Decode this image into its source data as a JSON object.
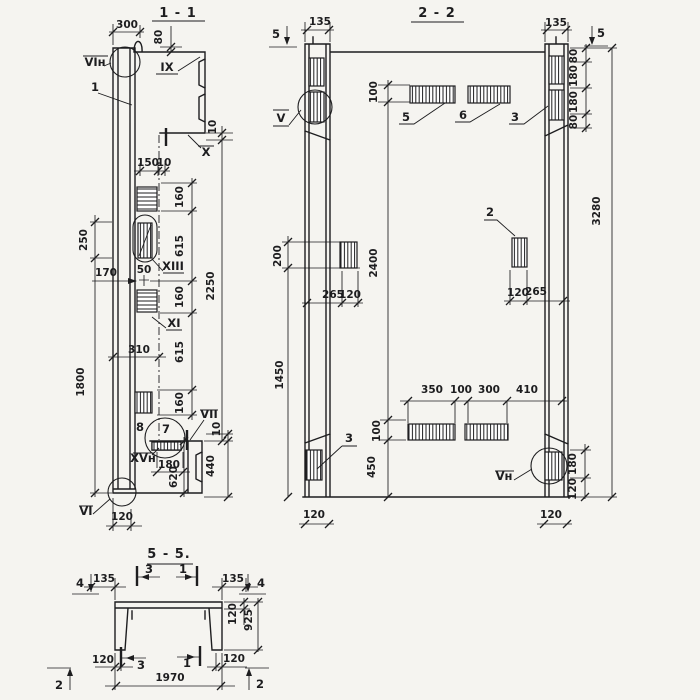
{
  "meta": {
    "ink": "#1d1d1f",
    "paper": "#f5f4f0"
  },
  "sections": {
    "s11": {
      "title": "1 - 1",
      "texts": [
        {
          "t": "300",
          "x": 127,
          "y": 28
        },
        {
          "t": "80",
          "x": 162,
          "y": 37,
          "r": 1
        },
        {
          "t": "VIн",
          "x": 95,
          "y": 66,
          "lbl": 1
        },
        {
          "t": "1",
          "x": 95,
          "y": 91,
          "lbl": 1
        },
        {
          "t": "IX",
          "x": 167,
          "y": 71,
          "lbl": 1
        },
        {
          "t": "10",
          "x": 216,
          "y": 127,
          "r": 1
        },
        {
          "t": "X",
          "x": 206,
          "y": 156,
          "lbl": 1
        },
        {
          "t": "150",
          "x": 148,
          "y": 166
        },
        {
          "t": "10",
          "x": 164,
          "y": 166
        },
        {
          "t": "160",
          "x": 183,
          "y": 197,
          "r": 1
        },
        {
          "t": "615",
          "x": 183,
          "y": 246,
          "r": 1
        },
        {
          "t": "160",
          "x": 183,
          "y": 297,
          "r": 1
        },
        {
          "t": "615",
          "x": 183,
          "y": 352,
          "r": 1
        },
        {
          "t": "160",
          "x": 183,
          "y": 403,
          "r": 1
        },
        {
          "t": "2250",
          "x": 214,
          "y": 286,
          "r": 1
        },
        {
          "t": "250",
          "x": 87,
          "y": 240,
          "r": 1
        },
        {
          "t": "1800",
          "x": 84,
          "y": 382,
          "r": 1
        },
        {
          "t": "170",
          "x": 106,
          "y": 276
        },
        {
          "t": "50",
          "x": 144,
          "y": 273
        },
        {
          "t": "XIII",
          "x": 173,
          "y": 270,
          "lbl": 1
        },
        {
          "t": "XI",
          "x": 174,
          "y": 327,
          "lbl": 1
        },
        {
          "t": "310",
          "x": 139,
          "y": 353
        },
        {
          "t": "8",
          "x": 140,
          "y": 431,
          "lbl": 1
        },
        {
          "t": "7",
          "x": 166,
          "y": 433,
          "lbl": 1
        },
        {
          "t": "VII",
          "x": 209,
          "y": 418,
          "lbl": 1
        },
        {
          "t": "10",
          "x": 220,
          "y": 429,
          "r": 1
        },
        {
          "t": "440",
          "x": 214,
          "y": 466,
          "r": 1
        },
        {
          "t": "XVн",
          "x": 143,
          "y": 462,
          "lbl": 1
        },
        {
          "t": "180",
          "x": 169,
          "y": 468
        },
        {
          "t": "620",
          "x": 177,
          "y": 477,
          "r": 1
        },
        {
          "t": "VI",
          "x": 86,
          "y": 515,
          "lbl": 1
        },
        {
          "t": "120",
          "x": 122,
          "y": 520
        }
      ]
    },
    "s22": {
      "title": "2 - 2",
      "texts": [
        {
          "t": "135",
          "x": 320,
          "y": 25
        },
        {
          "t": "135",
          "x": 556,
          "y": 26
        },
        {
          "t": "5",
          "x": 276,
          "y": 38,
          "lbl": 1
        },
        {
          "t": "5",
          "x": 601,
          "y": 37,
          "lbl": 1
        },
        {
          "t": "100",
          "x": 377,
          "y": 92,
          "r": 1
        },
        {
          "t": "5",
          "x": 406,
          "y": 121,
          "lbl": 1
        },
        {
          "t": "6",
          "x": 463,
          "y": 119,
          "lbl": 1
        },
        {
          "t": "3",
          "x": 515,
          "y": 121,
          "lbl": 1
        },
        {
          "t": "V",
          "x": 281,
          "y": 122,
          "lbl": 1
        },
        {
          "t": "80",
          "x": 577,
          "y": 56,
          "r": 1
        },
        {
          "t": "180",
          "x": 577,
          "y": 76,
          "r": 1
        },
        {
          "t": "180",
          "x": 577,
          "y": 102,
          "r": 1
        },
        {
          "t": "80",
          "x": 577,
          "y": 122,
          "r": 1
        },
        {
          "t": "3280",
          "x": 600,
          "y": 211,
          "r": 1
        },
        {
          "t": "200",
          "x": 281,
          "y": 256,
          "r": 1
        },
        {
          "t": "2400",
          "x": 377,
          "y": 263,
          "r": 1
        },
        {
          "t": "1450",
          "x": 283,
          "y": 375,
          "r": 1
        },
        {
          "t": "2",
          "x": 490,
          "y": 216,
          "lbl": 1
        },
        {
          "t": "265",
          "x": 333,
          "y": 298
        },
        {
          "t": "120",
          "x": 350,
          "y": 298
        },
        {
          "t": "120",
          "x": 518,
          "y": 296
        },
        {
          "t": "265",
          "x": 536,
          "y": 295
        },
        {
          "t": "350",
          "x": 432,
          "y": 393
        },
        {
          "t": "100",
          "x": 461,
          "y": 393
        },
        {
          "t": "300",
          "x": 489,
          "y": 393
        },
        {
          "t": "410",
          "x": 527,
          "y": 393
        },
        {
          "t": "100",
          "x": 380,
          "y": 431,
          "r": 1
        },
        {
          "t": "450",
          "x": 375,
          "y": 467,
          "r": 1
        },
        {
          "t": "3",
          "x": 349,
          "y": 442,
          "lbl": 1
        },
        {
          "t": "Vн",
          "x": 504,
          "y": 480,
          "lbl": 1
        },
        {
          "t": "180",
          "x": 576,
          "y": 464,
          "r": 1
        },
        {
          "t": "120",
          "x": 576,
          "y": 489,
          "r": 1
        },
        {
          "t": "120",
          "x": 314,
          "y": 518
        },
        {
          "t": "120",
          "x": 551,
          "y": 518
        }
      ]
    },
    "s55": {
      "title": "5 - 5.",
      "texts": [
        {
          "t": "4",
          "x": 80,
          "y": 587,
          "lbl": 1
        },
        {
          "t": "135",
          "x": 104,
          "y": 582
        },
        {
          "t": "3",
          "x": 149,
          "y": 573,
          "lbl": 1
        },
        {
          "t": "1",
          "x": 183,
          "y": 573,
          "lbl": 1
        },
        {
          "t": "135",
          "x": 233,
          "y": 582
        },
        {
          "t": "4",
          "x": 261,
          "y": 587,
          "lbl": 1
        },
        {
          "t": "120",
          "x": 236,
          "y": 614,
          "r": 1
        },
        {
          "t": "925",
          "x": 252,
          "y": 620,
          "r": 1
        },
        {
          "t": "120",
          "x": 103,
          "y": 663
        },
        {
          "t": "3",
          "x": 141,
          "y": 669,
          "lbl": 1
        },
        {
          "t": "1",
          "x": 187,
          "y": 667,
          "lbl": 1
        },
        {
          "t": "120",
          "x": 234,
          "y": 662
        },
        {
          "t": "1970",
          "x": 170,
          "y": 681
        },
        {
          "t": "2",
          "x": 59,
          "y": 689,
          "lbl": 1
        },
        {
          "t": "2",
          "x": 260,
          "y": 688,
          "lbl": 1
        }
      ]
    }
  }
}
